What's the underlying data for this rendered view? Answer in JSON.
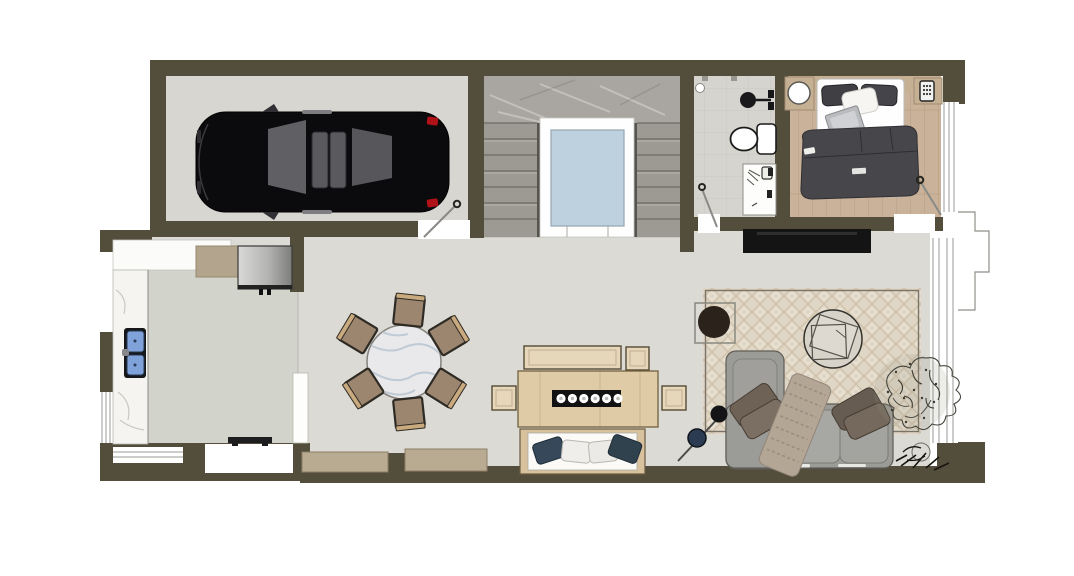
{
  "meta": {
    "content_type": "architectural-floor-plan",
    "view": "top-down rendered color plan",
    "canvas": {
      "width": 1074,
      "height": 576,
      "background": "#ffffff"
    }
  },
  "palette": {
    "wall": "#534d3c",
    "garage_floor": "#d8d6d1",
    "stair_floor": "#a9a6a1",
    "skylight": "#bdd1df",
    "bath_floor": "#d6d4cf",
    "bedroom_floor": "#c9b299",
    "kitchen_floor": "#d2d4cb",
    "main_floor": "#dbdad4",
    "rug_base": "#dfd6c6",
    "counter_white": "#f5f4f1",
    "sink_blue": "#7fa2da",
    "cabinet_wood": "#b3a48d",
    "chair_tan": "#9c8670",
    "table_wood": "#e0cba7",
    "bench_wood": "#e7d7ba",
    "sofa_gray": "#9b9b97",
    "duvet_gray": "#46464b",
    "navy_pillow": "#36485a",
    "tv_black": "#141414",
    "car_black": "#0b0b0d",
    "taillight_red": "#b01218"
  },
  "rooms": [
    {
      "id": "garage",
      "contents": [
        "black-car-top-view",
        "entry-door-swing"
      ]
    },
    {
      "id": "stair-hall",
      "contents": [
        "left-stair-flight",
        "right-stair-flight",
        "white-landing",
        "skylight-void"
      ]
    },
    {
      "id": "bathroom",
      "contents": [
        "floor-drain",
        "rain-shower-head",
        "toilet",
        "vanity-sink",
        "door-swing"
      ]
    },
    {
      "id": "bedroom",
      "contents": [
        "headboard-shelf",
        "round-side-table",
        "double-bed",
        "dark-pillows",
        "white-pillow",
        "laptop",
        "phone",
        "dark-duvet",
        "nightstand-with-phone",
        "side-window",
        "door-swing"
      ]
    },
    {
      "id": "kitchen",
      "contents": [
        "upper-cabinets",
        "refrigerator",
        "l-shaped-marble-counter",
        "double-blue-sink",
        "cooktop-strip",
        "half-wall",
        "side-window",
        "entry-opening"
      ]
    },
    {
      "id": "dining-room",
      "contents": [
        "round-marble-table",
        "six-tan-chairs",
        "rect-wood-table",
        "black-runner-six-plates",
        "bench",
        "three-side-chairs",
        "banquette-four-pillows",
        "two-wood-sideboards"
      ]
    },
    {
      "id": "living-room",
      "contents": [
        "tv-console",
        "diamond-pattern-rug",
        "round-side-table-dark",
        "round-coffee-table",
        "l-shaped-sofa",
        "throw-blanket",
        "taupe-cushions",
        "floor-lamp",
        "large-sketched-plant",
        "small-dark-plant",
        "bay-window"
      ]
    }
  ]
}
